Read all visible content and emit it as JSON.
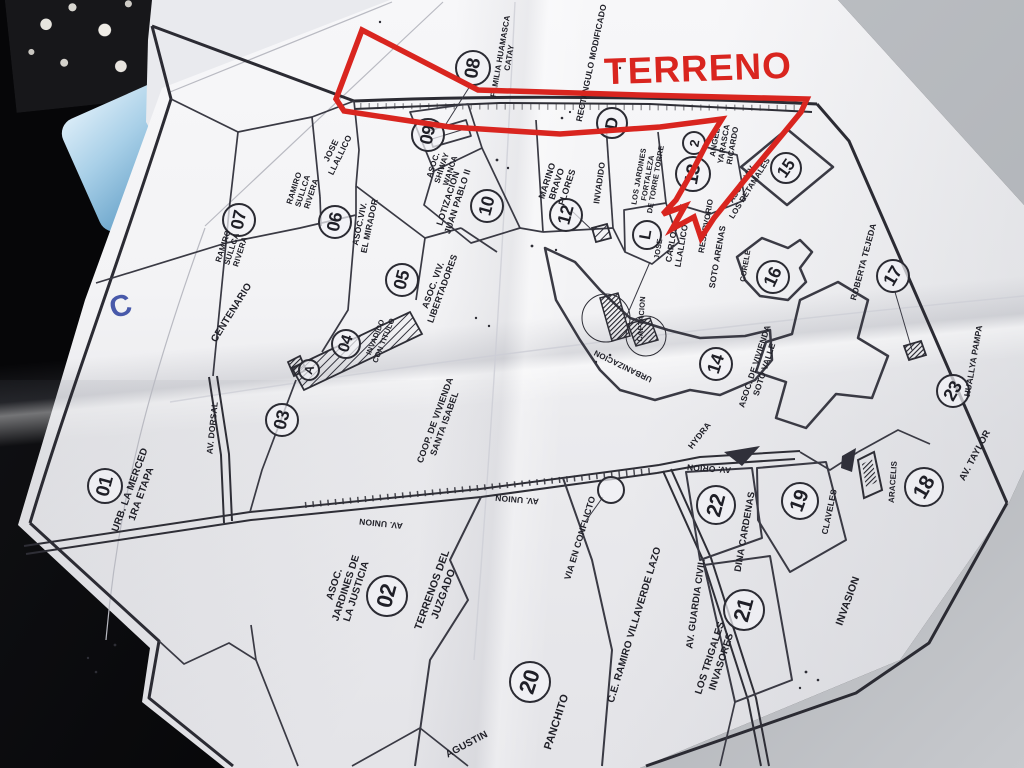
{
  "annotation": {
    "title": "TERRENO",
    "color": "#d9251f"
  },
  "photo": {
    "pen_mark": "C",
    "pen_color": "#2b3f9e"
  },
  "map": {
    "circles": [
      {
        "t": "01",
        "x": 105,
        "y": 486,
        "r": 18,
        "rot": -75
      },
      {
        "t": "02",
        "x": 387,
        "y": 596,
        "r": 21,
        "rot": -75
      },
      {
        "t": "03",
        "x": 282,
        "y": 420,
        "r": 17,
        "rot": -75
      },
      {
        "t": "04",
        "x": 346,
        "y": 344,
        "r": 15,
        "rot": -72
      },
      {
        "t": "A",
        "x": 309,
        "y": 370,
        "r": 11,
        "rot": -72
      },
      {
        "t": "05",
        "x": 402,
        "y": 280,
        "r": 17,
        "rot": -75
      },
      {
        "t": "06",
        "x": 335,
        "y": 222,
        "r": 17,
        "rot": -78
      },
      {
        "t": "07",
        "x": 239,
        "y": 220,
        "r": 17,
        "rot": -78
      },
      {
        "t": "08",
        "x": 473,
        "y": 68,
        "r": 18,
        "rot": -80
      },
      {
        "t": "09",
        "x": 428,
        "y": 135,
        "r": 17,
        "rot": -78
      },
      {
        "t": "10",
        "x": 487,
        "y": 206,
        "r": 17,
        "rot": -75
      },
      {
        "t": "12",
        "x": 566,
        "y": 215,
        "r": 17,
        "rot": -75
      },
      {
        "t": "D",
        "x": 612,
        "y": 123,
        "r": 16,
        "rot": -80
      },
      {
        "t": "13",
        "x": 693,
        "y": 174,
        "r": 18,
        "rot": -80
      },
      {
        "t": "2",
        "x": 694,
        "y": 143,
        "r": 12,
        "rot": -80
      },
      {
        "t": "L",
        "x": 647,
        "y": 235,
        "r": 15,
        "rot": -80
      },
      {
        "t": "14",
        "x": 716,
        "y": 364,
        "r": 17,
        "rot": -72
      },
      {
        "t": "15",
        "x": 786,
        "y": 168,
        "r": 16,
        "rot": -55
      },
      {
        "t": "16",
        "x": 773,
        "y": 277,
        "r": 17,
        "rot": -65
      },
      {
        "t": "17",
        "x": 893,
        "y": 276,
        "r": 17,
        "rot": -60
      },
      {
        "t": "18",
        "x": 924,
        "y": 487,
        "r": 20,
        "rot": -60
      },
      {
        "t": "19",
        "x": 800,
        "y": 501,
        "r": 19,
        "rot": -70
      },
      {
        "t": "20",
        "x": 530,
        "y": 682,
        "r": 21,
        "rot": -72
      },
      {
        "t": "21",
        "x": 744,
        "y": 610,
        "r": 21,
        "rot": -75
      },
      {
        "t": "22",
        "x": 716,
        "y": 505,
        "r": 20,
        "rot": -75
      },
      {
        "t": "23",
        "x": 953,
        "y": 391,
        "r": 17,
        "rot": -60
      },
      {
        "t": "",
        "x": 611,
        "y": 490,
        "r": 14,
        "rot": -75
      }
    ],
    "labels": [
      {
        "t": "URB. LA MERCED|1RA ETAPA",
        "x": 136,
        "y": 492,
        "rot": -70,
        "s": 10
      },
      {
        "t": "ASOC.|JARDINES DE|LA JUSTICIA",
        "x": 346,
        "y": 588,
        "rot": -72,
        "s": 10
      },
      {
        "t": "TERRENOS DEL|JUZGADO",
        "x": 438,
        "y": 592,
        "rot": -70,
        "s": 10.5
      },
      {
        "t": "AV. DORSAL",
        "x": 213,
        "y": 428,
        "rot": -84,
        "s": 8.5
      },
      {
        "t": "CENTENARIO",
        "x": 232,
        "y": 313,
        "rot": -58,
        "s": 10
      },
      {
        "t": "RAMIRO|SULLCA|RIVERA",
        "x": 232,
        "y": 249,
        "rot": -72,
        "s": 8
      },
      {
        "t": "RAMIRO|SULLCA|RIVERA",
        "x": 303,
        "y": 191,
        "rot": -72,
        "s": 8
      },
      {
        "t": "JOSE|LLALLICO",
        "x": 336,
        "y": 153,
        "rot": -64,
        "s": 8.5
      },
      {
        "t": "ASOC.VIV.|EL MIRADOR",
        "x": 365,
        "y": 225,
        "rot": -78,
        "s": 8.5
      },
      {
        "t": "ASOC. VIV.|LIBERTADORES",
        "x": 438,
        "y": 287,
        "rot": -70,
        "s": 9
      },
      {
        "t": "INVADIDO|CON TITULO",
        "x": 380,
        "y": 339,
        "rot": -68,
        "s": 7.5
      },
      {
        "t": "COOP. DE VIVIENDA|SANTA ISABEL",
        "x": 440,
        "y": 422,
        "rot": -70,
        "s": 9
      },
      {
        "t": "LOTIZACION|JUAN PABLO II",
        "x": 453,
        "y": 200,
        "rot": -72,
        "s": 9
      },
      {
        "t": "ASOC.|SHIWAY|WANCA",
        "x": 442,
        "y": 168,
        "rot": -72,
        "s": 8
      },
      {
        "t": "FAMILIA HUAMASCA|CATAY",
        "x": 505,
        "y": 57,
        "rot": -80,
        "s": 8
      },
      {
        "t": "MARINO|BRAVO|FLORES",
        "x": 557,
        "y": 184,
        "rot": -72,
        "s": 9
      },
      {
        "t": "INVADIDO",
        "x": 600,
        "y": 183,
        "rot": -82,
        "s": 8.5
      },
      {
        "t": "RECTANGULO MODIFICADO",
        "x": 592,
        "y": 63,
        "rot": -78,
        "s": 8.5
      },
      {
        "t": "LOS JARDINES|FORTALEZA|DE TORRE TORRE",
        "x": 648,
        "y": 178,
        "rot": -80,
        "s": 7.5
      },
      {
        "t": "JOSE",
        "x": 659,
        "y": 249,
        "rot": -80,
        "s": 7.5
      },
      {
        "t": "CARLOS|LLALLICO",
        "x": 677,
        "y": 245,
        "rot": -80,
        "s": 8.5
      },
      {
        "t": "RESERVORIO",
        "x": 706,
        "y": 226,
        "rot": -80,
        "s": 8
      },
      {
        "t": "SOTO ARENAS",
        "x": 718,
        "y": 257,
        "rot": -80,
        "s": 8.5
      },
      {
        "t": "CORELE",
        "x": 746,
        "y": 266,
        "rot": -80,
        "s": 7.5
      },
      {
        "t": "ANGEL|YARASCA|RICARDO",
        "x": 724,
        "y": 144,
        "rot": -80,
        "s": 8
      },
      {
        "t": "ASOC. VIV.|LOS RETAMALES",
        "x": 746,
        "y": 186,
        "rot": -58,
        "s": 8
      },
      {
        "t": "ASOC. DE VIVIENDA|SOTO VALLE",
        "x": 760,
        "y": 368,
        "rot": -72,
        "s": 8.5
      },
      {
        "t": "ROBERTA TEJEDA",
        "x": 864,
        "y": 262,
        "rot": -75,
        "s": 8.5
      },
      {
        "t": "HUALLYA PAMPA",
        "x": 974,
        "y": 361,
        "rot": -80,
        "s": 8.5
      },
      {
        "t": "AV. TAYLOR",
        "x": 976,
        "y": 456,
        "rot": -62,
        "s": 9.5
      },
      {
        "t": "ARACELIS",
        "x": 893,
        "y": 482,
        "rot": -86,
        "s": 8
      },
      {
        "t": "CLAVELES",
        "x": 830,
        "y": 512,
        "rot": -78,
        "s": 8.5
      },
      {
        "t": "INVASION",
        "x": 848,
        "y": 601,
        "rot": -70,
        "s": 10.5
      },
      {
        "t": "DINA CARDENAS",
        "x": 746,
        "y": 532,
        "rot": -80,
        "s": 9.5
      },
      {
        "t": "AV. GUARDIA CIVIL",
        "x": 697,
        "y": 604,
        "rot": -82,
        "s": 9.5
      },
      {
        "t": "LOS TRIGALES|INVASORES",
        "x": 716,
        "y": 660,
        "rot": -72,
        "s": 10
      },
      {
        "t": "C.E. RAMIRO VILLAVERDE LAZO",
        "x": 635,
        "y": 625,
        "rot": -73,
        "s": 10
      },
      {
        "t": "VIA EN CONFLICTO",
        "x": 580,
        "y": 538,
        "rot": -73,
        "s": 9
      },
      {
        "t": "PANCHITO",
        "x": 557,
        "y": 722,
        "rot": -72,
        "s": 11
      },
      {
        "t": "AGUSTIN",
        "x": 467,
        "y": 745,
        "rot": -28,
        "s": 10
      },
      {
        "t": "HYDRA",
        "x": 700,
        "y": 436,
        "rot": -52,
        "s": 8.5
      },
      {
        "t": "AV. ORION",
        "x": 709,
        "y": 468,
        "rot": 184,
        "s": 8.5
      },
      {
        "t": "AV. UNION",
        "x": 381,
        "y": 523,
        "rot": 186,
        "s": 8.5
      },
      {
        "t": "AV. UNION",
        "x": 517,
        "y": 499,
        "rot": 185,
        "s": 8.5
      },
      {
        "t": "URBANIZACION",
        "x": 623,
        "y": 366,
        "rot": 206,
        "s": 8
      },
      {
        "t": "CAPTACION",
        "x": 642,
        "y": 319,
        "rot": -86,
        "s": 7.5
      }
    ]
  }
}
